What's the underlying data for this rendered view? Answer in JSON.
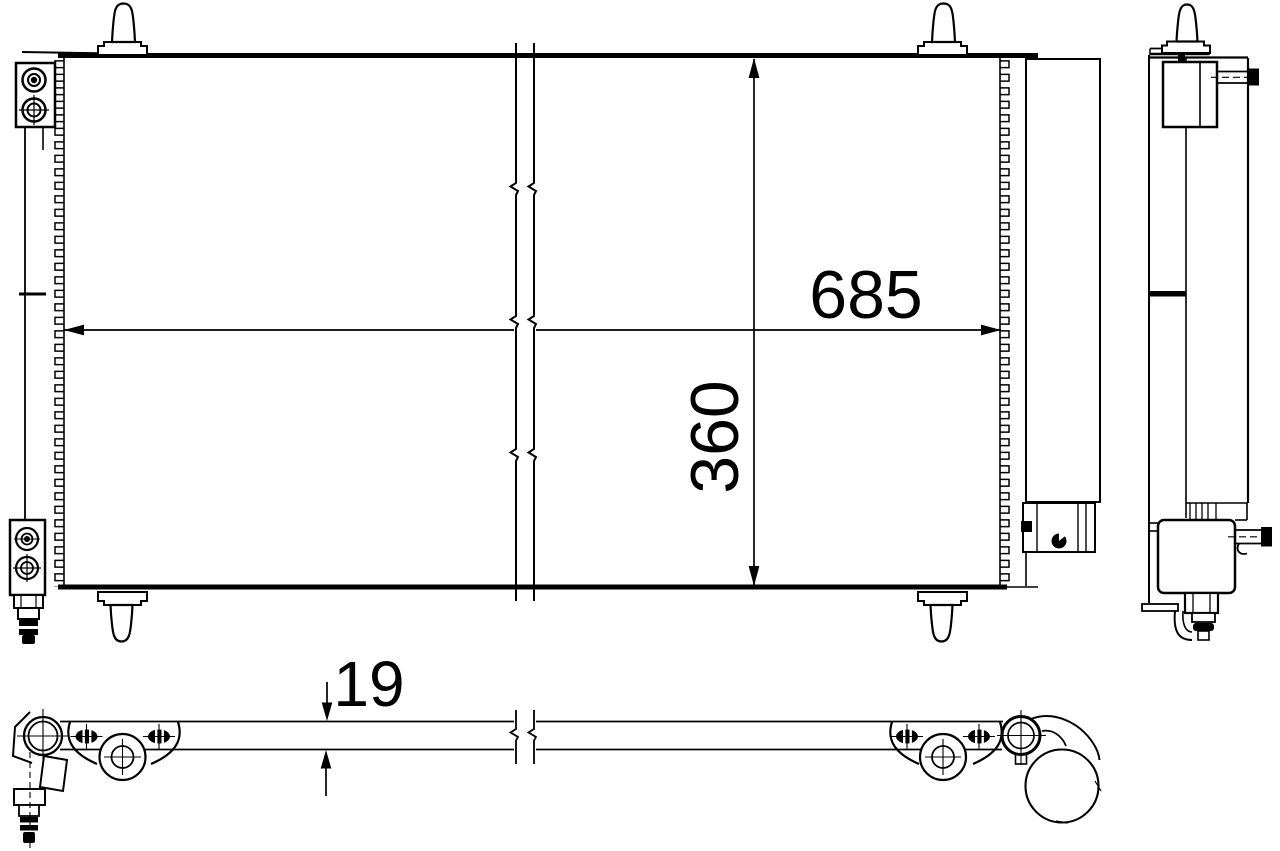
{
  "drawing": {
    "background_color": "#ffffff",
    "line_color": "#000000",
    "dimension_labels": {
      "width": "685",
      "height": "360",
      "depth": "19"
    }
  }
}
